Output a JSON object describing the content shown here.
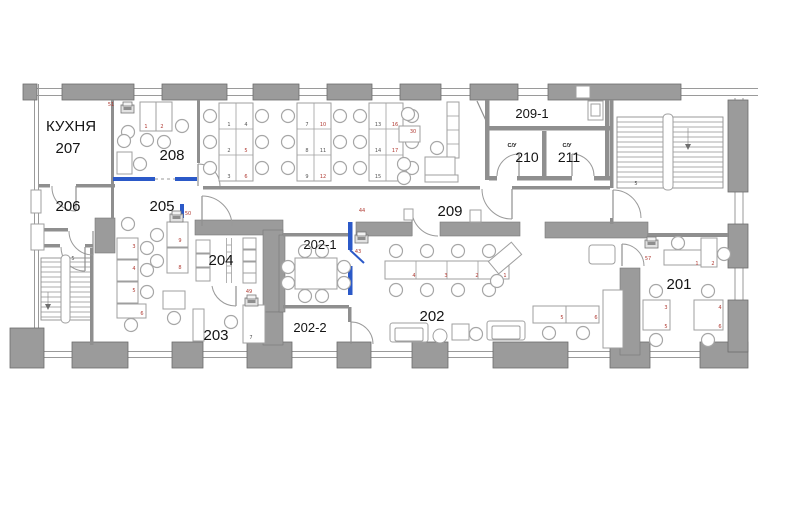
{
  "plan": {
    "title": "Office floor plan",
    "colors": {
      "wall_gray": "#9b9b9b",
      "accent_blue": "#2b59c8",
      "tag_red": "#b03a32",
      "text": "#141414"
    },
    "icons": [
      {
        "name": "printer-icon",
        "room": "208"
      },
      {
        "name": "printer-icon",
        "room": "205"
      },
      {
        "name": "printer-icon",
        "room": "209"
      },
      {
        "name": "printer-icon",
        "room": "203"
      },
      {
        "name": "printer-icon",
        "room": "202"
      },
      {
        "name": "printer-icon",
        "room": "201"
      }
    ],
    "room_labels": [
      {
        "t": "КУХНЯ",
        "x": 71,
        "y": 131,
        "fs": 15
      },
      {
        "t": "207",
        "x": 68,
        "y": 153,
        "fs": 15
      },
      {
        "t": "206",
        "x": 68,
        "y": 211,
        "fs": 15
      },
      {
        "t": "208",
        "x": 172,
        "y": 160,
        "fs": 15
      },
      {
        "t": "205",
        "x": 162,
        "y": 211,
        "fs": 15
      },
      {
        "t": "204",
        "x": 221,
        "y": 265,
        "fs": 15
      },
      {
        "t": "203",
        "x": 216,
        "y": 340,
        "fs": 15
      },
      {
        "t": "202-1",
        "x": 320,
        "y": 249,
        "fs": 13
      },
      {
        "t": "202-2",
        "x": 310,
        "y": 332,
        "fs": 13
      },
      {
        "t": "202",
        "x": 432,
        "y": 321,
        "fs": 15
      },
      {
        "t": "209",
        "x": 450,
        "y": 216,
        "fs": 15
      },
      {
        "t": "209-1",
        "x": 532,
        "y": 118,
        "fs": 13
      },
      {
        "t": "С/У",
        "x": 512,
        "y": 147,
        "fs": 5.5,
        "b": 1
      },
      {
        "t": "210",
        "x": 527,
        "y": 162,
        "fs": 14
      },
      {
        "t": "С/У",
        "x": 567,
        "y": 147,
        "fs": 5.5,
        "b": 1
      },
      {
        "t": "211",
        "x": 569,
        "y": 162,
        "fs": 14
      },
      {
        "t": "201",
        "x": 679,
        "y": 289,
        "fs": 15
      }
    ],
    "tags": [
      {
        "t": "51",
        "x": 111,
        "y": 106,
        "c": "r"
      },
      {
        "t": "1",
        "x": 146,
        "y": 128,
        "c": "r"
      },
      {
        "t": "2",
        "x": 162,
        "y": 128,
        "c": "r"
      },
      {
        "t": "50",
        "x": 188,
        "y": 215,
        "c": "r"
      },
      {
        "t": "44",
        "x": 362,
        "y": 212,
        "c": "r"
      },
      {
        "t": "49",
        "x": 249,
        "y": 293,
        "c": "r"
      },
      {
        "t": "43",
        "x": 358,
        "y": 253,
        "c": "r"
      },
      {
        "t": "57",
        "x": 648,
        "y": 260,
        "c": "r"
      },
      {
        "t": "30",
        "x": 413,
        "y": 133,
        "c": "r"
      },
      {
        "t": "1",
        "x": 229,
        "y": 126,
        "c": "d"
      },
      {
        "t": "4",
        "x": 246,
        "y": 126,
        "c": "d"
      },
      {
        "t": "2",
        "x": 229,
        "y": 152,
        "c": "d"
      },
      {
        "t": "5",
        "x": 246,
        "y": 152,
        "c": "r"
      },
      {
        "t": "3",
        "x": 229,
        "y": 178,
        "c": "d"
      },
      {
        "t": "6",
        "x": 246,
        "y": 178,
        "c": "r"
      },
      {
        "t": "7",
        "x": 307,
        "y": 126,
        "c": "d"
      },
      {
        "t": "10",
        "x": 323,
        "y": 126,
        "c": "r"
      },
      {
        "t": "8",
        "x": 307,
        "y": 152,
        "c": "d"
      },
      {
        "t": "11",
        "x": 323,
        "y": 152,
        "c": "d"
      },
      {
        "t": "9",
        "x": 307,
        "y": 178,
        "c": "d"
      },
      {
        "t": "12",
        "x": 323,
        "y": 178,
        "c": "r"
      },
      {
        "t": "13",
        "x": 378,
        "y": 126,
        "c": "d"
      },
      {
        "t": "16",
        "x": 395,
        "y": 126,
        "c": "r"
      },
      {
        "t": "14",
        "x": 378,
        "y": 152,
        "c": "d"
      },
      {
        "t": "17",
        "x": 395,
        "y": 152,
        "c": "r"
      },
      {
        "t": "15",
        "x": 378,
        "y": 178,
        "c": "d"
      },
      {
        "t": "4",
        "x": 414,
        "y": 277,
        "c": "r"
      },
      {
        "t": "3",
        "x": 446,
        "y": 277,
        "c": "r"
      },
      {
        "t": "2",
        "x": 477,
        "y": 277,
        "c": "r"
      },
      {
        "t": "1",
        "x": 505,
        "y": 277,
        "c": "r"
      },
      {
        "t": "5",
        "x": 562,
        "y": 319,
        "c": "r"
      },
      {
        "t": "6",
        "x": 596,
        "y": 319,
        "c": "r"
      },
      {
        "t": "1",
        "x": 697,
        "y": 265,
        "c": "r"
      },
      {
        "t": "2",
        "x": 713,
        "y": 265,
        "c": "r"
      },
      {
        "t": "3",
        "x": 666,
        "y": 309,
        "c": "r"
      },
      {
        "t": "5",
        "x": 666,
        "y": 328,
        "c": "r"
      },
      {
        "t": "4",
        "x": 720,
        "y": 309,
        "c": "r"
      },
      {
        "t": "6",
        "x": 720,
        "y": 328,
        "c": "r"
      },
      {
        "t": "3",
        "x": 134,
        "y": 248,
        "c": "r"
      },
      {
        "t": "4",
        "x": 134,
        "y": 270,
        "c": "r"
      },
      {
        "t": "5",
        "x": 134,
        "y": 292,
        "c": "r"
      },
      {
        "t": "6",
        "x": 142,
        "y": 315,
        "c": "r"
      },
      {
        "t": "9",
        "x": 180,
        "y": 242,
        "c": "r"
      },
      {
        "t": "8",
        "x": 180,
        "y": 269,
        "c": "r"
      },
      {
        "t": "7",
        "x": 251,
        "y": 339,
        "c": "d"
      },
      {
        "t": "5",
        "x": 73,
        "y": 260,
        "c": "d"
      },
      {
        "t": "5",
        "x": 636,
        "y": 185,
        "c": "d"
      }
    ]
  }
}
